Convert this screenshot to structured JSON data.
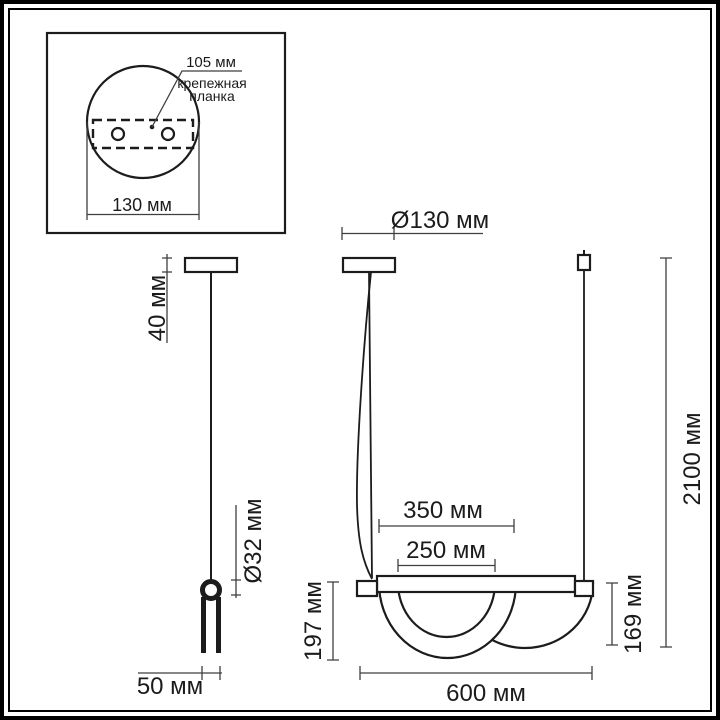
{
  "drawing": {
    "type": "technical-dimension-drawing",
    "inset_mount_view": {
      "hole_spacing_label": "105 мм",
      "bracket_label_line1": "крепежная",
      "bracket_label_line2": "планка",
      "base_width_label": "130 мм"
    },
    "side_view": {
      "canopy_height_label": "40 мм",
      "ring_diameter_label": "Ø32 мм",
      "fork_width_label": "50 мм"
    },
    "front_view": {
      "canopy_diameter_label": "Ø130 мм",
      "shade_outer_width_label": "350 мм",
      "shade_inner_width_label": "250 мм",
      "front_shade_height_label": "197 мм",
      "rear_shade_height_label": "169 мм",
      "fixture_width_label": "600 мм",
      "overall_height_label": "2100 мм"
    },
    "colors": {
      "object_line": "#1c1c1c",
      "dimension_line": "#3f3f3f",
      "background": "#ffffff"
    }
  }
}
